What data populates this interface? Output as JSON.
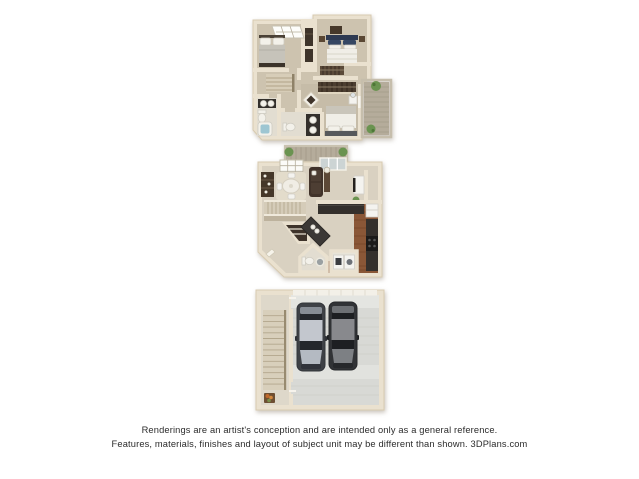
{
  "disclaimer": {
    "line1": "Renderings are an artist's conception and are intended only as a general reference.",
    "line2": "Features, materials, finishes and layout of subject unit may be different than shown. 3DPlans.com",
    "brand": "3DPlans.com"
  },
  "floors": [
    {
      "id": "upper-level",
      "position": "top",
      "rooms": [
        "bedroom-left",
        "bedroom-right",
        "hall-with-stairs",
        "full-bathroom",
        "master-bathroom",
        "master-bedroom",
        "walk-in-closet",
        "balcony-with-plants"
      ]
    },
    {
      "id": "main-level",
      "position": "middle",
      "rooms": [
        "dining-area",
        "living-area",
        "kitchen",
        "pantry-under-stairs",
        "half-bathroom",
        "laundry-closet",
        "stairs",
        "deck-with-plants",
        "entry"
      ]
    },
    {
      "id": "garage-level",
      "position": "bottom",
      "rooms": [
        "two-car-garage",
        "stairwell-with-landing"
      ],
      "vehicles": [
        "silver-car",
        "dark-gray-car"
      ]
    }
  ],
  "colors": {
    "background": "#ffffff",
    "wall": "#eae1cf",
    "wall_shade": "#cfc2a9",
    "carpet": "#cdc3af",
    "carpet_dark": "#c6bca8",
    "tile": "#e2ddd1",
    "tile_main": "#d9d1c1",
    "rug": "#e3dccb",
    "wood_floor": "#8a5737",
    "cabinet_dark": "#34302c",
    "furniture_brown": "#46382a",
    "sofa_brown": "#41332a",
    "bedding_white": "#f0eee7",
    "navy_accent": "#2e3a52",
    "plant_green": "#6a9350",
    "deck_wood": "#b5ac9b",
    "water_blue": "#9ec6d2",
    "garage_floor": "#d8d9d5",
    "car_silver_roof": "#c3c7ce",
    "car_silver_body": "#3e4146",
    "car_gray_roof": "#88898d",
    "car_gray_body": "#313336",
    "text": "#2b2b2b"
  }
}
